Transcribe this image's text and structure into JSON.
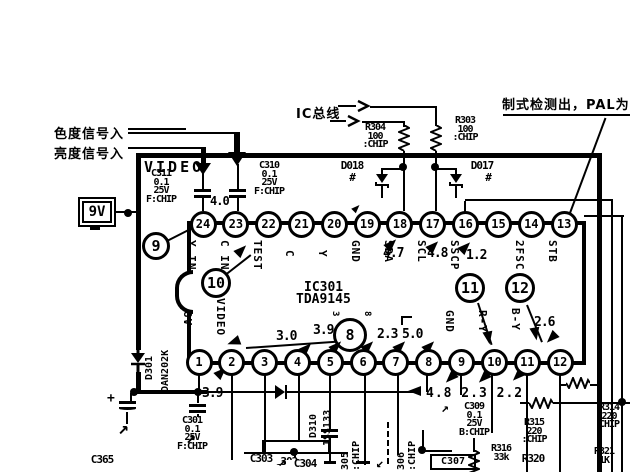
{
  "annotations": {
    "chroma_in": "色度信号入",
    "luma_in": "亮度信号入",
    "ic_bus": "IC总线",
    "standard_detect": "制式检测出，PAL为",
    "video": "VIDEO",
    "supply": "9V"
  },
  "ic": {
    "ref": "IC301",
    "part": "TDA9145"
  },
  "pins": {
    "top": [
      {
        "n": "24",
        "name": "Y IN"
      },
      {
        "n": "23",
        "name": "C IN"
      },
      {
        "n": "22",
        "name": "TEST"
      },
      {
        "n": "21",
        "name": "C"
      },
      {
        "n": "20",
        "name": "Y"
      },
      {
        "n": "19",
        "name": "GND"
      },
      {
        "n": "18",
        "name": "SDA",
        "value": "4.7"
      },
      {
        "n": "17",
        "name": "SCL",
        "value": "4.8"
      },
      {
        "n": "16",
        "name": "SSCP",
        "value": "1.2"
      },
      {
        "n": "15",
        "name": ""
      },
      {
        "n": "14",
        "name": "2FSC"
      },
      {
        "n": "13",
        "name": "STB"
      }
    ],
    "bottom": [
      {
        "n": "1",
        "name": "8V"
      },
      {
        "n": "2",
        "name": "VIDEO"
      },
      {
        "n": "3",
        "name": ""
      },
      {
        "n": "4",
        "name": "",
        "value": "3.0"
      },
      {
        "n": "5",
        "name": "",
        "value": "3.9"
      },
      {
        "n": "6",
        "name": "",
        "value": "2.3",
        "alt": "3"
      },
      {
        "n": "7",
        "name": "",
        "value": "2.3",
        "alt": "8"
      },
      {
        "n": "8",
        "name": "",
        "value": "5.0"
      },
      {
        "n": "9",
        "name": "GND"
      },
      {
        "n": "10",
        "name": "R-Y"
      },
      {
        "n": "11",
        "name": "B-Y"
      },
      {
        "n": "12",
        "name": "",
        "value": "2.6"
      }
    ]
  },
  "misc_values": {
    "pin24_ac": "4.0",
    "pin1": "3.9",
    "bottom_row": "4.8 2.3 2.2"
  },
  "callouts": {
    "c8": "8",
    "c9": "9",
    "c10": "10",
    "c11": "11",
    "c12": "12"
  },
  "components": {
    "c311": [
      "C311",
      "0.1",
      "25V",
      "F:CHIP"
    ],
    "c310": [
      "C310",
      "0.1",
      "25V",
      "F:CHIP"
    ],
    "c301": [
      "C301",
      "0.1",
      "25V",
      "F:CHIP"
    ],
    "c309": [
      "C309",
      "0.1",
      "25V",
      "B:CHIP"
    ],
    "r304": [
      "R304",
      "100",
      ":CHIP"
    ],
    "r303": [
      "R303",
      "100",
      ":CHIP"
    ],
    "r315": [
      "R315",
      "220",
      ":CHIP"
    ],
    "r314": [
      "R314",
      "220",
      "CHIP"
    ],
    "r316": [
      "R316",
      "33k"
    ],
    "r320": [
      "R320"
    ],
    "r321": [
      "R321",
      "1K"
    ],
    "d018": [
      "D018",
      "#"
    ],
    "d017": [
      "D017",
      "#"
    ],
    "d301": [
      "D301",
      "DAN202K"
    ],
    "d310": [
      "D310",
      "1SS133"
    ],
    "c365": [
      "C365"
    ],
    "c302": [
      "C302"
    ],
    "c303": [
      "C303"
    ],
    "c304": [
      "C304"
    ],
    "c305": [
      "305",
      ":CHIP"
    ],
    "c306": [
      "306",
      ":CHIP"
    ],
    "c307": [
      "C307"
    ],
    "plus_sign": "+"
  }
}
